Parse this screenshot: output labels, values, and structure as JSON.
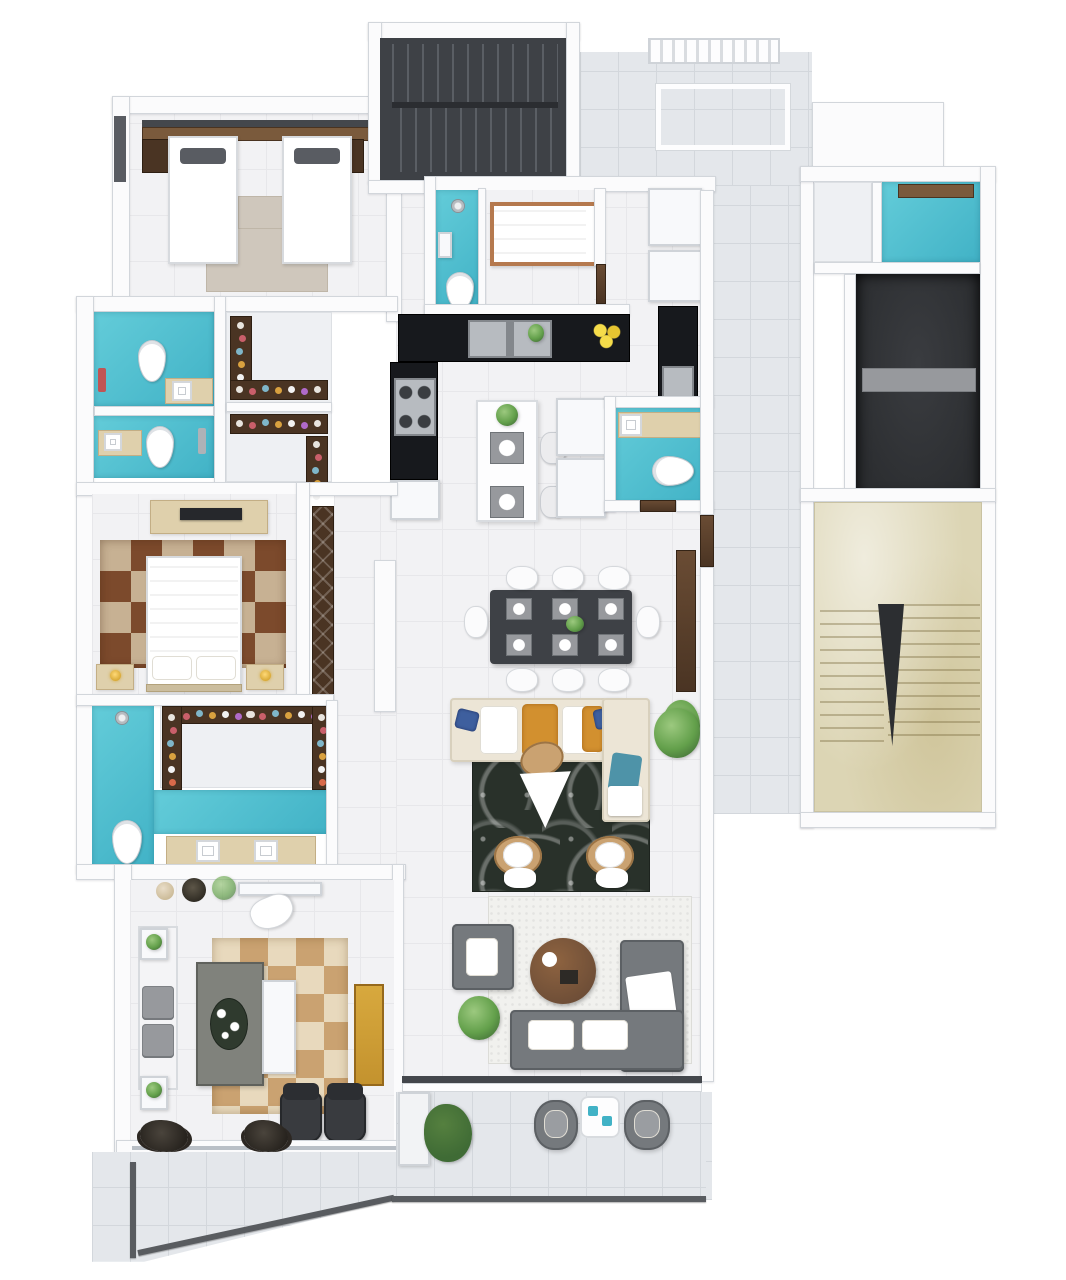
{
  "scene": {
    "type": "3d-floor-plan",
    "view": "top-down render, no visible text labels",
    "rooms": [
      {
        "name": "twin-bedroom",
        "floor": "floor",
        "furniture": [
          "twin-bed",
          "twin-bed",
          "headboard-shelf",
          "beige-rug"
        ]
      },
      {
        "name": "dark-stairwell",
        "floor": "stair-dark",
        "furniture": [
          "stair-flight-upper",
          "stair-flight-lower"
        ]
      },
      {
        "name": "entry-corridor",
        "floor": "tile",
        "furniture": [
          "entry-grille",
          "door-mat"
        ]
      },
      {
        "name": "shared-bathroom-upper",
        "floor": "teal",
        "furniture": [
          "toilet",
          "vanity-sink",
          "towel"
        ]
      },
      {
        "name": "shared-bathroom-lower",
        "floor": "teal",
        "furniture": [
          "toilet",
          "vanity-sink",
          "towel"
        ]
      },
      {
        "name": "walk-in-closet-kids",
        "floor": "floor",
        "furniture": [
          "shoe-shelves",
          "clothes-rails"
        ]
      },
      {
        "name": "single-bedroom",
        "floor": "floor",
        "furniture": [
          "single-bed-copper-frame"
        ]
      },
      {
        "name": "ensuite-bathroom",
        "floor": "teal",
        "furniture": [
          "shower",
          "toilet",
          "shelf"
        ]
      },
      {
        "name": "kitchen",
        "floor": "floor",
        "furniture": [
          "black-l-counter",
          "double-sink",
          "gas-stove",
          "island-with-plates",
          "two-stools",
          "fridge-cabinets",
          "tall-black-unit-with-oven"
        ]
      },
      {
        "name": "powder-room",
        "floor": "teal",
        "furniture": [
          "vanity-sink",
          "toilet"
        ]
      },
      {
        "name": "dining-area",
        "floor": "floor",
        "furniture": [
          "dark-dining-table",
          "eight-white-chairs",
          "six-place-settings",
          "tv-wood-panel",
          "plant"
        ]
      },
      {
        "name": "living-area",
        "floor": "floor",
        "furniture": [
          "cream-l-sofa",
          "orange-cushions",
          "blue-pillows",
          "dark-pattern-rug",
          "white-triangle-coffee-table",
          "two-tan-armchairs",
          "plant"
        ]
      },
      {
        "name": "master-bedroom",
        "floor": "floor",
        "furniture": [
          "double-bed",
          "patchwork-rug",
          "tv-console",
          "two-nightstands-with-lamps",
          "wardrobe"
        ]
      },
      {
        "name": "master-bathroom",
        "floor": "teal",
        "furniture": [
          "shower",
          "toilet",
          "double-vanity"
        ]
      },
      {
        "name": "master-walk-in-closet",
        "floor": "floor",
        "furniture": [
          "u-shaped-shelves-with-clothes"
        ]
      },
      {
        "name": "home-office",
        "floor": "floor",
        "furniture": [
          "gray-desk",
          "white-cabinet",
          "gold-bookshelf",
          "two-office-chairs",
          "daybed",
          "patch-tan-rug",
          "console-with-chair"
        ]
      },
      {
        "name": "family-room",
        "floor": "floor",
        "furniture": [
          "gray-sectional-sofa",
          "gray-armchair",
          "round-wood-coffee-table",
          "white-shag-rug",
          "plant"
        ]
      },
      {
        "name": "service-storage",
        "floor": "white-floor",
        "furniture": []
      },
      {
        "name": "laundry-room",
        "floor": "teal",
        "furniture": [
          "wood-shelf"
        ]
      },
      {
        "name": "utility-shaft",
        "floor": "shaft-dark",
        "furniture": [
          "gray-shelf"
        ]
      },
      {
        "name": "marble-stair-hall",
        "floor": "marble",
        "furniture": [
          "stair-flight-left",
          "stair-flight-right"
        ]
      },
      {
        "name": "balcony-terrace",
        "floor": "tile",
        "furniture": [
          "two-outdoor-chairs",
          "outdoor-table",
          "bushes",
          "planter",
          "railing"
        ]
      }
    ]
  },
  "palette": {
    "wall": "#fbfbfc",
    "wall-edge": "#d2d6db",
    "floor": "#f2f2f4",
    "floor-line": "#e7e7ea",
    "tile": "#e4e7eb",
    "tile-line": "#d3d7dc",
    "white-floor": "#eef0f3",
    "teal-a": "#63ccd9",
    "teal-b": "#41b2c6",
    "stair-dark": "#3e4146",
    "tread-light": "#5a5e64",
    "marble": "#dcd5b4",
    "marble-vein": "#eae4cc",
    "shaft-dark": "#2c2e31",
    "shelf-gray": "#97999d",
    "counter-black": "#17191d",
    "steel": "#b7bbc0",
    "steel-dark": "#83878c",
    "wood": "#6e4e37",
    "wood-dark": "#4a3423",
    "wood-mid": "#7a5a3c",
    "copper": "#b5794e",
    "beige": "#dfd0ac",
    "beige-dark": "#cbbd9e",
    "rug-beige": "#cfc7bc",
    "rug-dark-a": "#29312a",
    "rug-shag": "#f1f1ee",
    "cream": "#ece5d6",
    "orange": "#d2902f",
    "blue-pillow": "#3e5f9e",
    "teal-pillow": "#4e93a8",
    "pillow-dark": "#595c62",
    "sofa-gray": "#75797d",
    "sofa-gray-dark": "#5c6064",
    "green-a": "#9cc97f",
    "green-b": "#63a04b",
    "green-dark": "#3f6b35",
    "gold": "#c3922e",
    "gold-lamp": "#d8a936",
    "desk-gray": "#80827c",
    "tray-green": "#2f3a2e",
    "chair-dark": "#393b3f",
    "track-dark": "#44474c",
    "rail-gray": "#595c60",
    "patch-brown-a": "#7c4a2c",
    "patch-brown-b": "#c7b193",
    "patch-tan-a": "#caa271",
    "patch-tan-b": "#e8d9bd"
  }
}
